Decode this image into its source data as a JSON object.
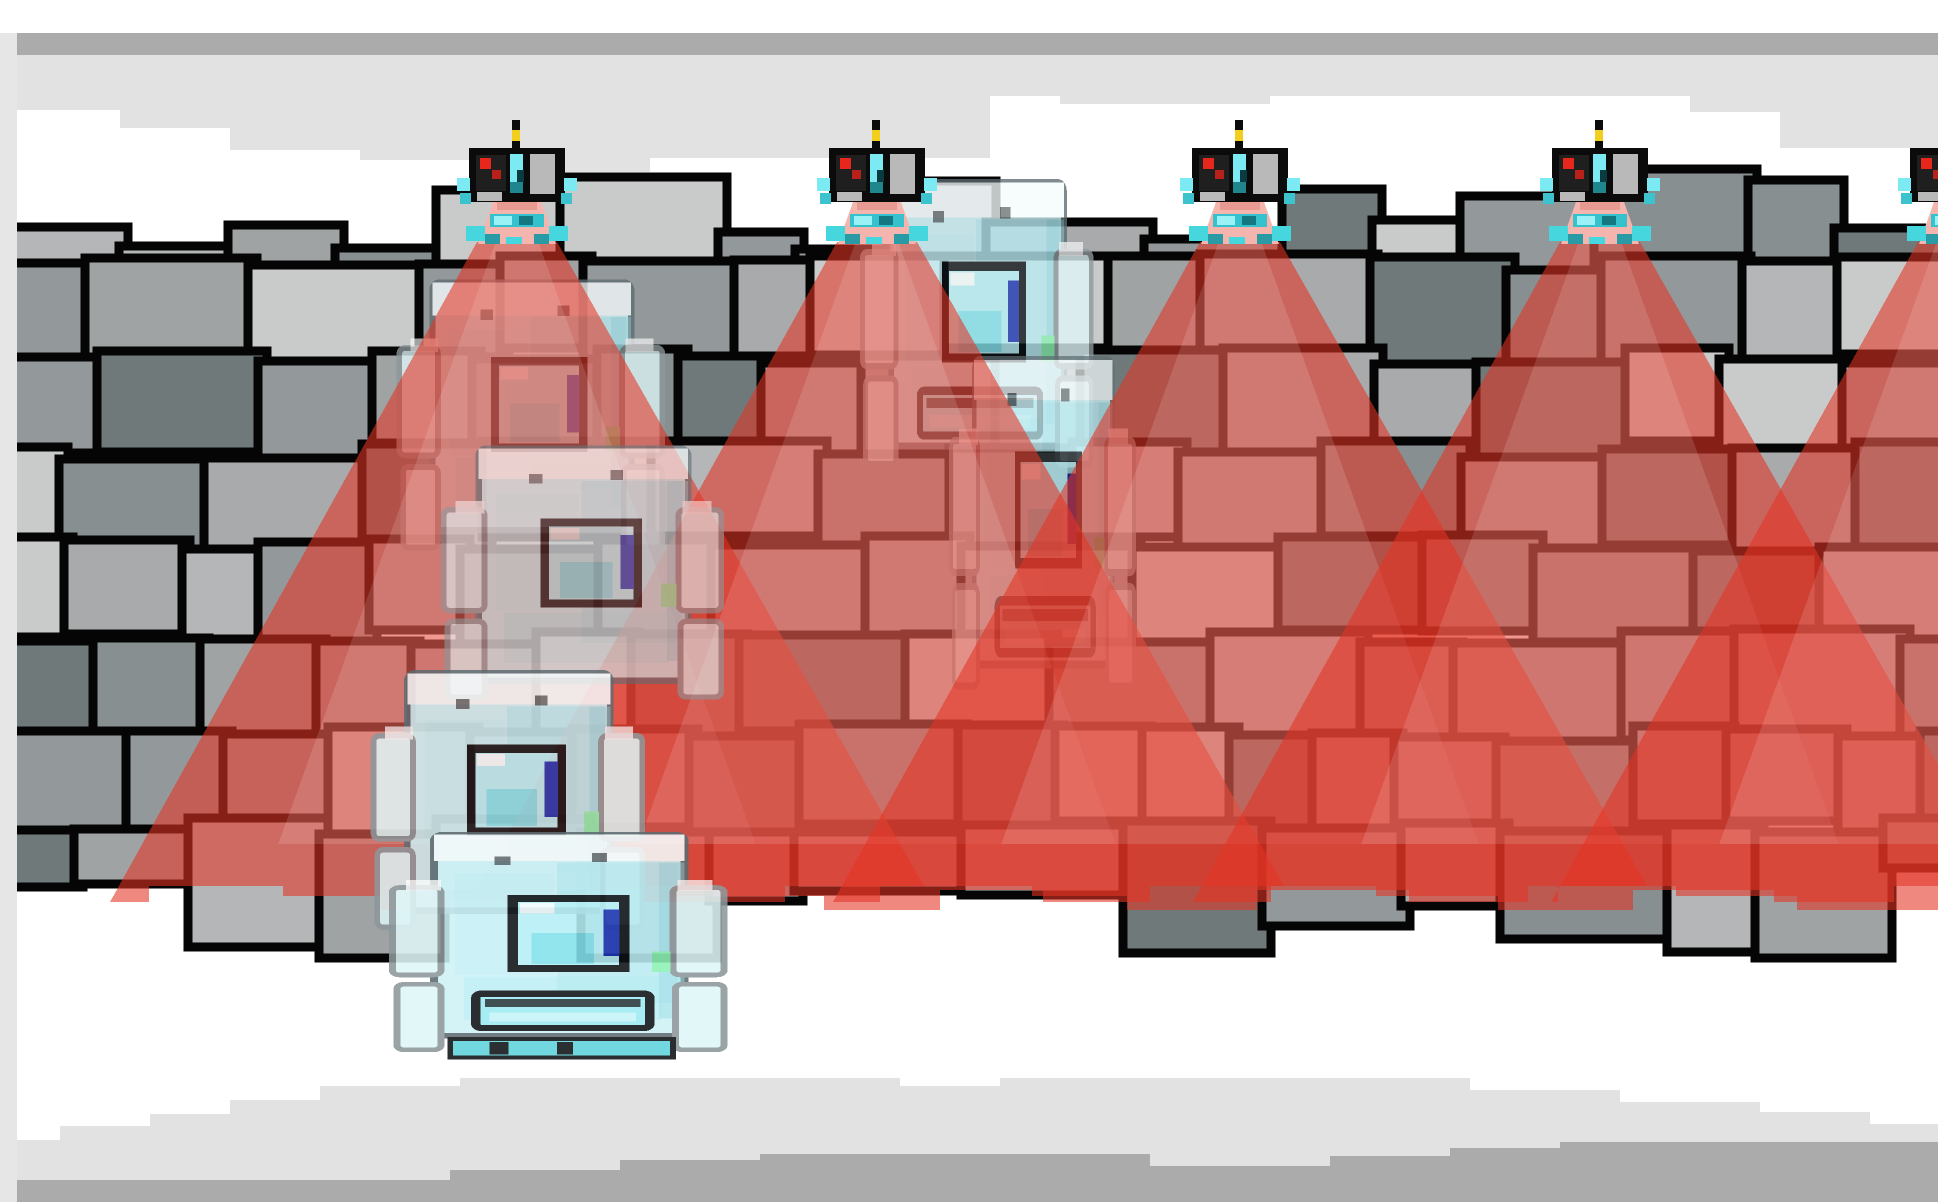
{
  "frame": {
    "background": "#ffffff",
    "left_strip_color": "#e6e6e6"
  },
  "clouds": {
    "top_band_color": "#ababab",
    "top_light_color": "#e2e2e2",
    "top_mid_strip_color": "#cdcdcd",
    "bottom_light_color": "#e2e2e2",
    "bottom_band_color": "#ababab"
  },
  "wall": {
    "seed": 13,
    "rows": 8,
    "left_x": 16,
    "right_x": 1938,
    "joint_color": "#050505",
    "palette": [
      "#b4b6b7",
      "#6f797a",
      "#9fa3a4",
      "#c9cbcb",
      "#878f90",
      "#a8aaab",
      "#93999a"
    ]
  },
  "entities": {
    "turrets": {
      "positions_x": [
        517,
        877,
        1240,
        1600,
        1958
      ],
      "base_y": 244,
      "colors": {
        "shell": "#0b0b0b",
        "antenna_light": "#f2cf1c",
        "camera_dot": "#e8271c",
        "camera_dot_dark": "#b8201a",
        "lens_cyan": "#7ceaf2",
        "lens_teal": "#3cc3cd",
        "panel_gray": "#b9b9b9",
        "base_pink": "#f3b5ad",
        "band_teal": "#36c2cc",
        "knob_teal": "#46d6de",
        "knob_dark": "#2a9aa4"
      }
    },
    "vision_cones": {
      "color": "#e43424",
      "opacity": 0.58,
      "core_color": "#ffffff",
      "core_opacity": 0.13,
      "apex_y": 242,
      "apex_half_width": 40,
      "edge_slope": 0.57,
      "bottom_y": 886
    },
    "robots": {
      "colors": {
        "body": "#cdf2f7",
        "bevel": "#f6fcfd",
        "outline": "#5d6b71",
        "arm_fill": "#dff6f8",
        "arm_outline": "#8d989c",
        "eye_fill": "#b6eff6",
        "eye_frame": "#0d1215",
        "eye_blue_bar": "#1c35b2",
        "mouth_fill": "#9debf2",
        "accent_green": "#8df2b4",
        "feet_teal": "#5fd3dc"
      },
      "instances": [
        {
          "id": "ghost-robot-top",
          "x": 392,
          "y": 250,
          "sx": 0.92,
          "sy": 0.96,
          "opacity": 0.78,
          "layer": "back",
          "mouth": false,
          "feet": false
        },
        {
          "id": "ghost-robot-wall-right",
          "x": 856,
          "y": 148,
          "sx": 0.8,
          "sy": 1.02,
          "opacity": 0.78,
          "layer": "back",
          "mouth": true,
          "feet": false
        },
        {
          "id": "ghost-robot-wall-column",
          "x": 946,
          "y": 320,
          "sx": 0.64,
          "sy": 1.18,
          "opacity": 0.7,
          "layer": "back",
          "mouth": true,
          "feet": false
        },
        {
          "id": "ghost-robot-mid-upper",
          "x": 436,
          "y": 418,
          "sx": 0.97,
          "sy": 0.9,
          "opacity": 0.6,
          "layer": "front",
          "mouth": false,
          "feet": false
        },
        {
          "id": "ghost-robot-mid-lower",
          "x": 366,
          "y": 642,
          "sx": 0.94,
          "sy": 0.92,
          "opacity": 0.84,
          "layer": "front",
          "mouth": false,
          "feet": false
        },
        {
          "id": "ghost-robot-bottom",
          "x": 383,
          "y": 808,
          "sx": 1.16,
          "sy": 0.78,
          "opacity": 0.88,
          "layer": "front",
          "mouth": true,
          "feet": true
        }
      ]
    }
  }
}
